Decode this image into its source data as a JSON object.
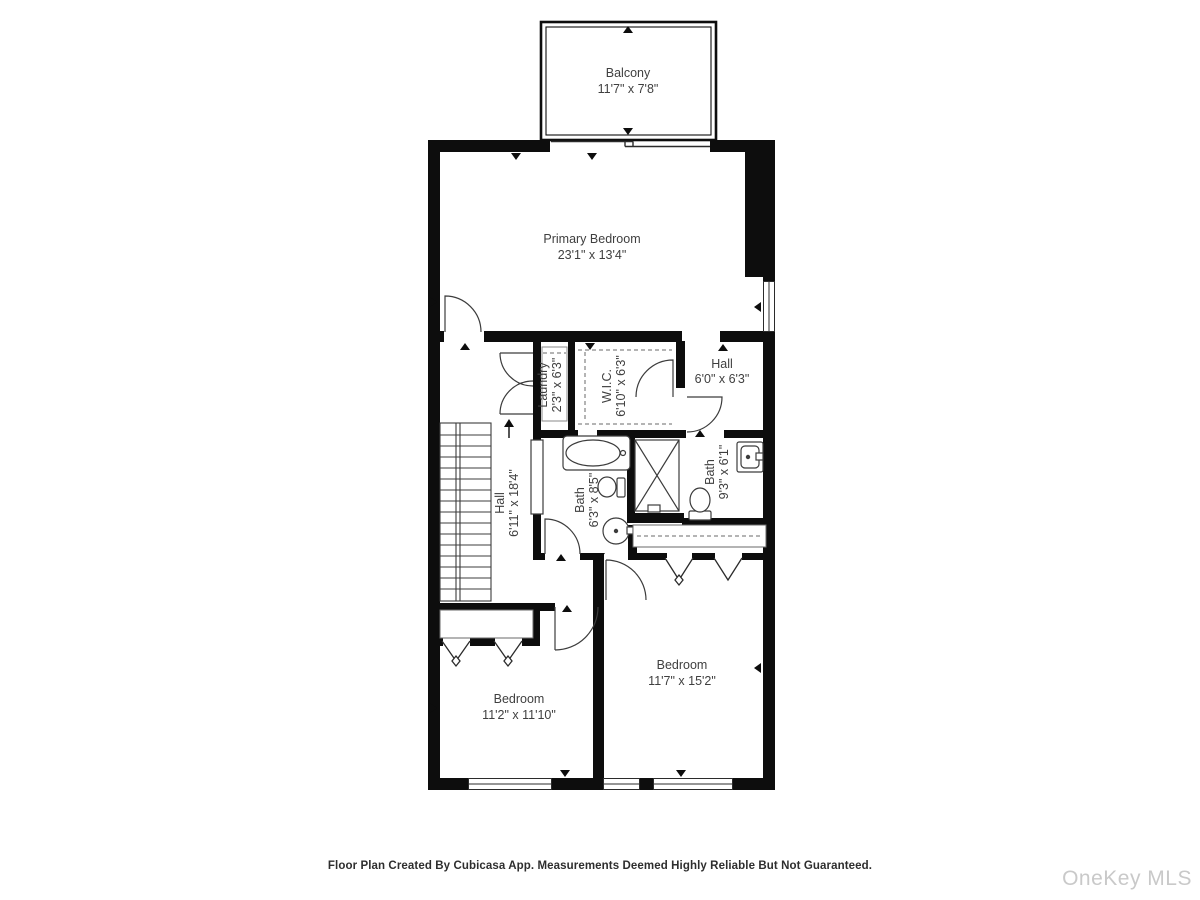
{
  "rooms": {
    "balcony": {
      "name": "Balcony",
      "dims": "11'7\" x 7'8\""
    },
    "primary_bedroom": {
      "name": "Primary Bedroom",
      "dims": "23'1\" x 13'4\""
    },
    "laundry": {
      "name": "Laundry",
      "dims": "2'3\" x 6'3\""
    },
    "wic": {
      "name": "W.I.C.",
      "dims": "6'10\" x 6'3\""
    },
    "hall_upper": {
      "name": "Hall",
      "dims": "6'0\" x 6'3\""
    },
    "hall_main": {
      "name": "Hall",
      "dims": "6'11\" x 18'4\""
    },
    "bath_left": {
      "name": "Bath",
      "dims": "6'3\" x 8'5\""
    },
    "bath_right": {
      "name": "Bath",
      "dims": "9'3\" x 6'1\""
    },
    "bedroom_left": {
      "name": "Bedroom",
      "dims": "11'2\" x 11'10\""
    },
    "bedroom_right": {
      "name": "Bedroom",
      "dims": "11'7\" x 15'2\""
    }
  },
  "footer": {
    "disclaimer": "Floor Plan Created By Cubicasa App. Measurements Deemed Highly Reliable But Not Guaranteed."
  },
  "watermark": {
    "text": "OneKey MLS"
  },
  "colors": {
    "wall": "#0d0d0d",
    "fixture_line": "#3c3c3c",
    "text": "#3f3f3f",
    "watermark": "#c9c9c9",
    "background": "#ffffff"
  }
}
